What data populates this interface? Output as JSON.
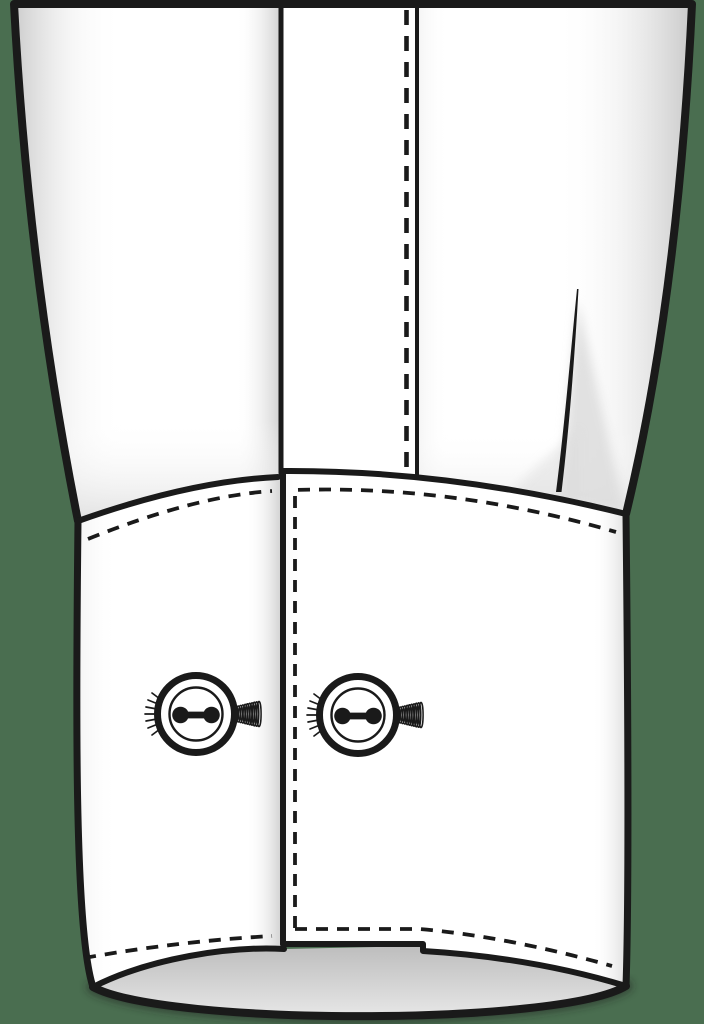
{
  "illustration": {
    "subject": "shirt-sleeve-barrel-cuff-front-view",
    "button_count": 2,
    "text_labels": []
  },
  "colors": {
    "background": "#4a6e50",
    "outline": "#1a1a1a",
    "fabric": "#ffffff",
    "shade_soft": "#dcdcdc",
    "shade_strong": "#c3c3c3",
    "opening_top": "#bdbdbd",
    "opening_bottom": "#e9e9e9"
  }
}
